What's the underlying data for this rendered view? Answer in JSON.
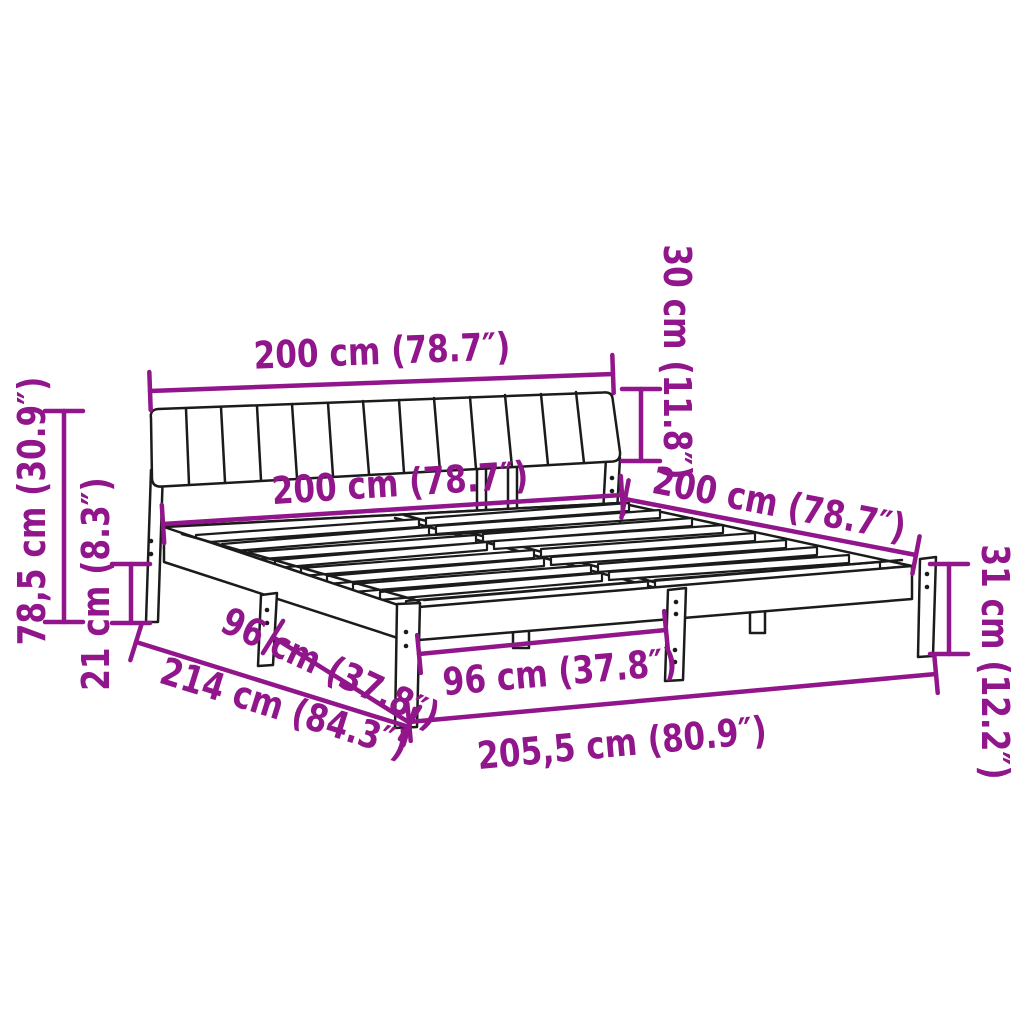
{
  "diagram": {
    "product": "bed-frame-with-headboard-dimension-diagram",
    "colors": {
      "dimension_annotation": "#91158B",
      "line_art": "#1b1b1b",
      "background": "#ffffff"
    },
    "dimensions": {
      "headboard_width": "200 cm (78.7″)",
      "bed_width": "200 cm (78.7″)",
      "bed_length": "200 cm (78.7″)",
      "cushion_height": "30 cm (11.8″)",
      "headboard_height": "78,5 cm (30.9″)",
      "clearance_height": "21 cm (8.3″)",
      "frame_height": "31 cm (12.2″)",
      "side_leg_spacing": "96 cm (37.8″)",
      "front_leg_spacing": "96 cm (37.8″)",
      "frame_length": "205,5 cm (80.9″)",
      "total_length": "214 cm (84.3″)"
    }
  }
}
